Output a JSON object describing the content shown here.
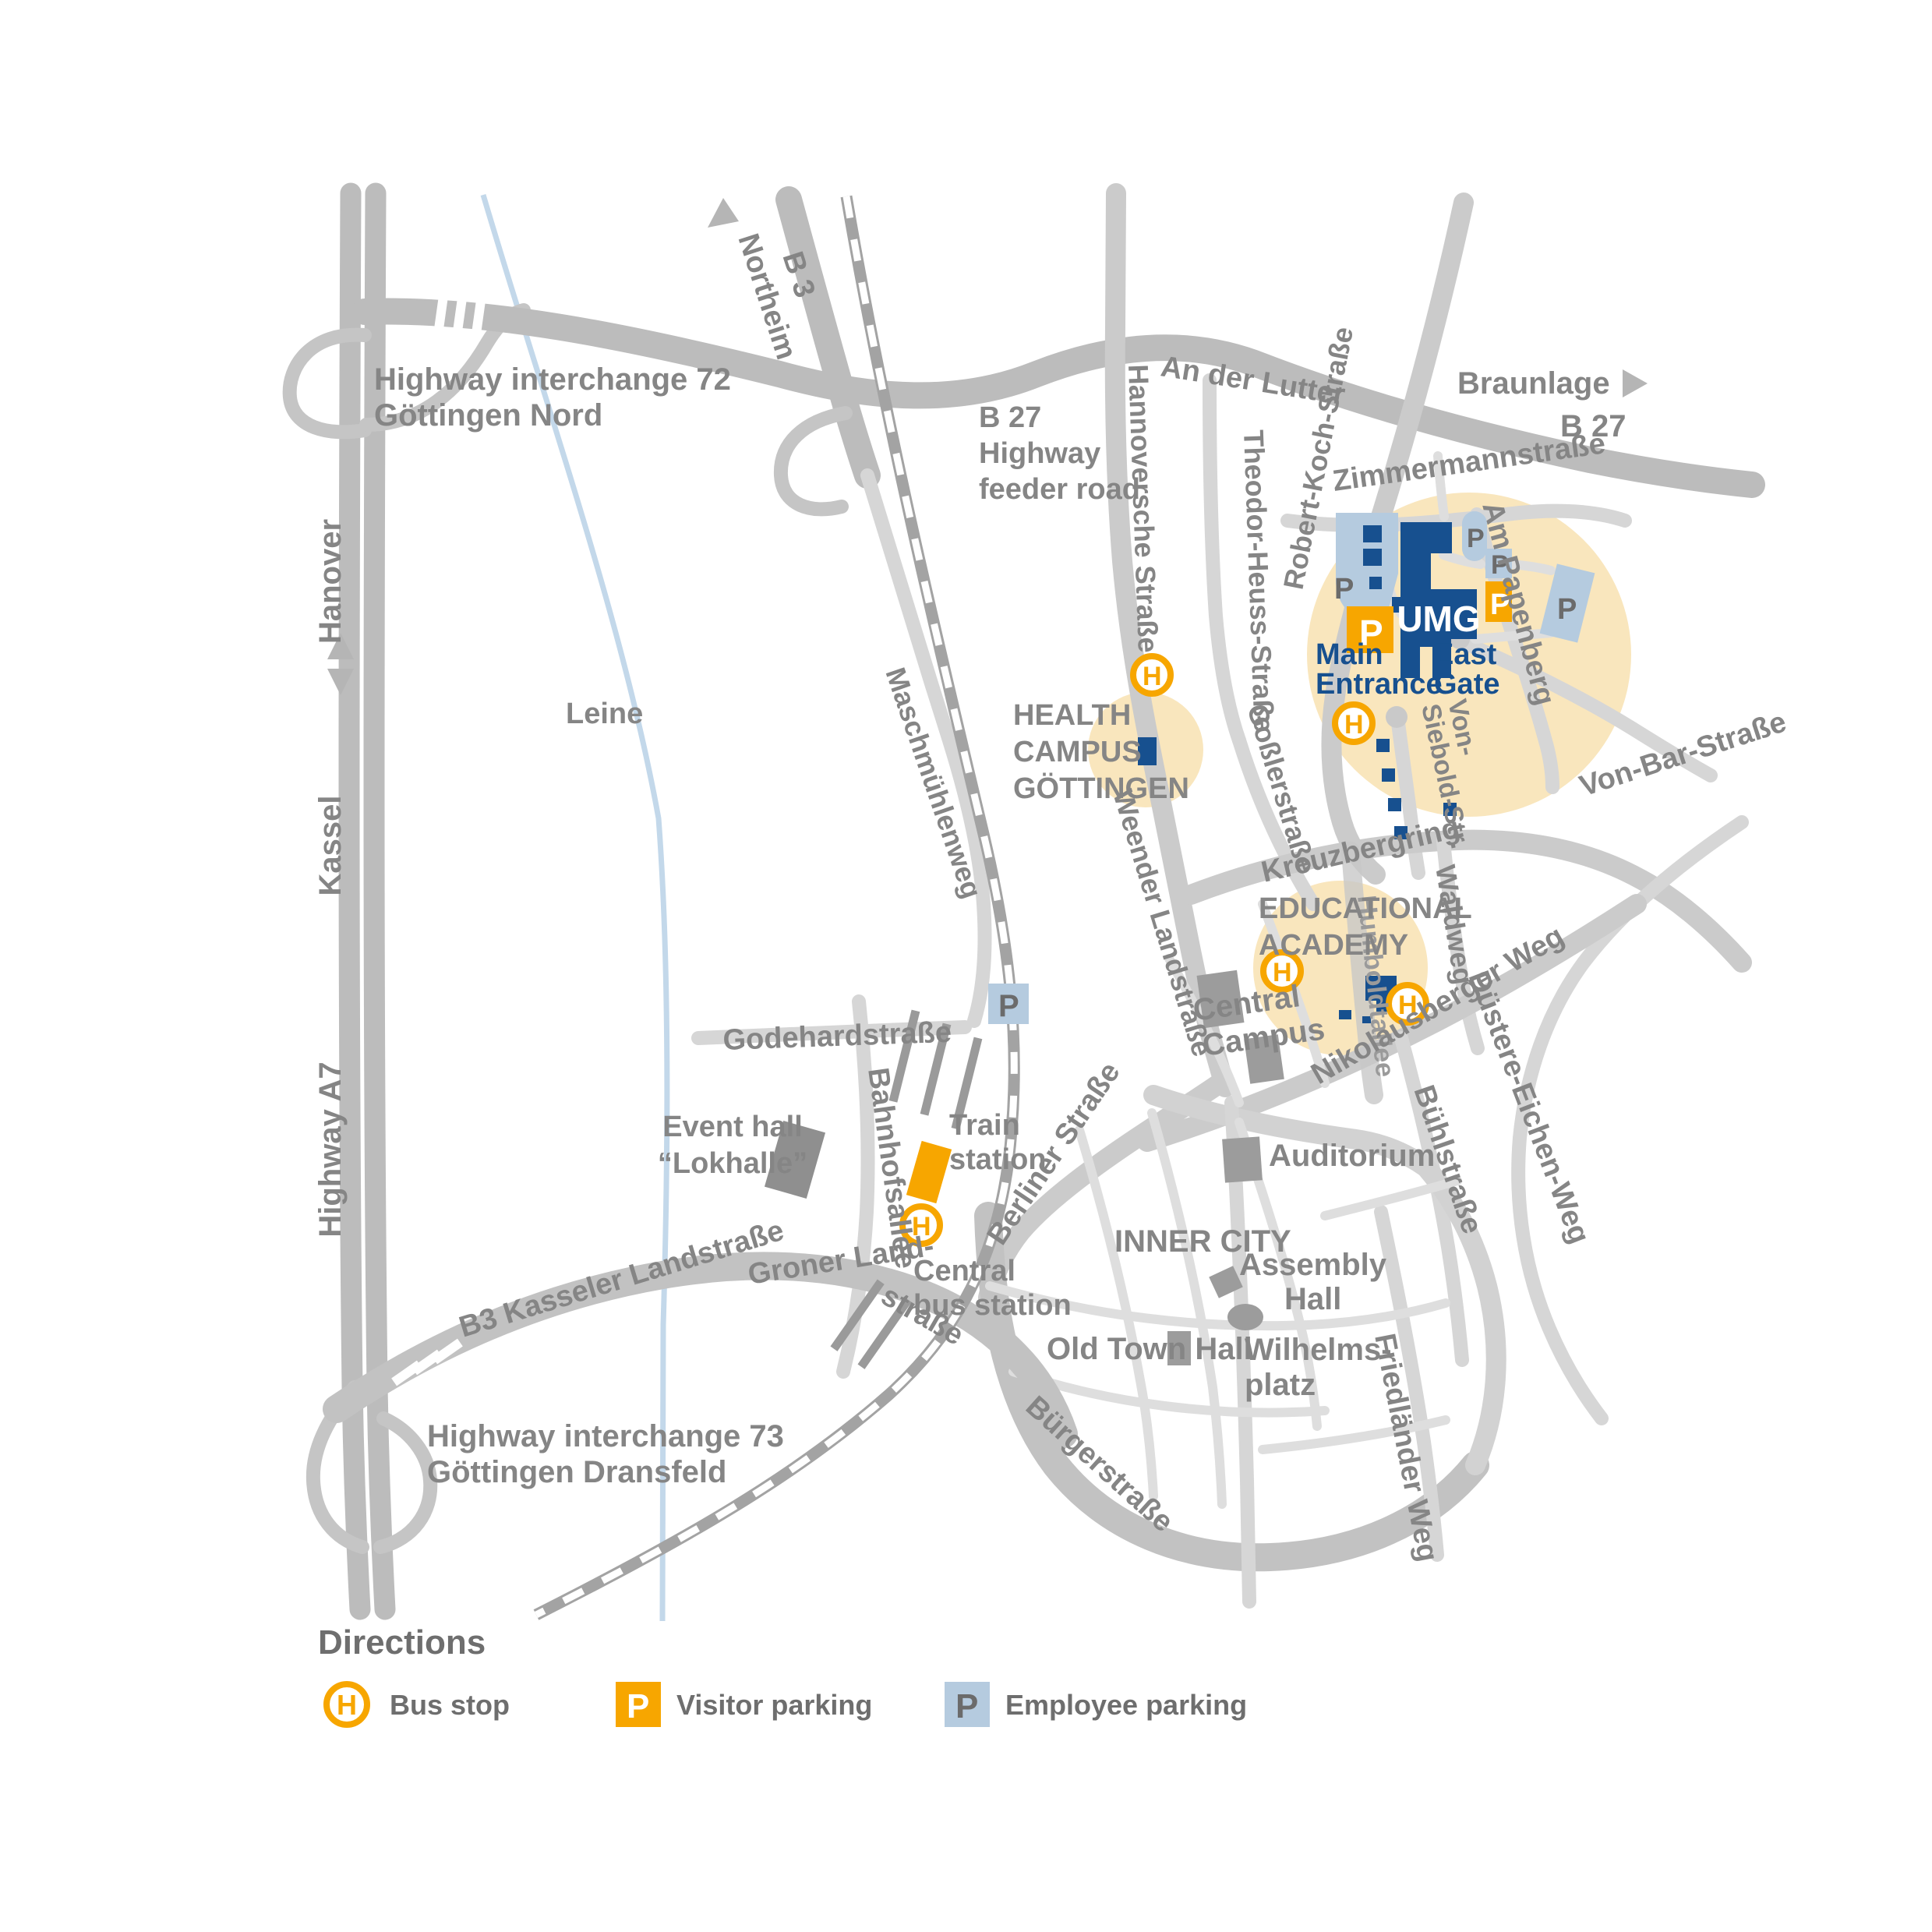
{
  "colors": {
    "accent_orange": "#F7A600",
    "umg_blue": "#17508F",
    "employee_parking_blue": "#B5CBDF",
    "campus_halo_beige": "#F9E6BD"
  },
  "icons": {
    "bus": "H",
    "parking": "P"
  },
  "legend": {
    "title": "Directions",
    "bus_stop": "Bus stop",
    "visitor_parking": "Visitor parking",
    "employee_parking": "Employee parking"
  },
  "highways": {
    "interchange_72": [
      "Highway interchange 72",
      "Göttingen Nord"
    ],
    "interchange_73": [
      "Highway interchange 73",
      "Göttingen Dransfeld"
    ],
    "a7": "Highway A7",
    "hanover": "Hanover",
    "kassel": "Kassel",
    "northeim": "Northeim",
    "braunlage": "Braunlage",
    "b3": "B 3",
    "b27": "B 27",
    "b27_feeder": [
      "B 27",
      "Highway",
      "feeder road"
    ]
  },
  "streets": {
    "an_der_lutter": "An der Lutter",
    "hannoversche": "Hannoversche Straße",
    "theodor_heuss": "Theodor-Heuss-Straße",
    "robert_koch": "Robert-Koch-Straße",
    "zimmermann": "Zimmermannstraße",
    "am_papenberg": "Am Papenberg",
    "von_siebold": [
      "Von-",
      "Siebold-Str."
    ],
    "von_bar": "Von-Bar-Straße",
    "kreuzbergring": "Kreuzbergring",
    "gossler": "Goßlerstraße",
    "weender": "Weender Landstraße",
    "maschmuehlenweg": "Maschmühlenweg",
    "humboldtallee": "Humboldtallee",
    "nikolausberger": "Nikolausberger Weg",
    "waldweg": "Waldweg",
    "buehl": "Bühlstraße",
    "duestere_eichen": "Düstere-Eichen-Weg",
    "friedlaender": "Friedländer Weg",
    "buerger": "Bürgerstraße",
    "berliner": "Berliner Straße",
    "kasseler": "B3 Kasseler Landstraße",
    "groner_1": "Groner Land-",
    "groner_2": "straße",
    "godehard": "Godehardstraße",
    "bahnhofsallee": "Bahnhofsallee"
  },
  "campus": {
    "umg": "UMG",
    "main_entrance": [
      "Main",
      "Entrance"
    ],
    "east_gate": [
      "East",
      "Gate"
    ],
    "health_campus": [
      "HEALTH",
      "CAMPUS",
      "GÖTTINGEN"
    ],
    "educational_academy": [
      "EDUCATIONAL",
      "ACADEMY"
    ]
  },
  "places": {
    "central_campus": [
      "Central",
      "Campus"
    ],
    "auditorium": "Auditorium",
    "inner_city": "INNER CITY",
    "assembly_hall": [
      "Assembly",
      "Hall"
    ],
    "wilhelmsplatz": [
      "Wilhelms-",
      "platz"
    ],
    "old_town_hall": "Old Town Hall",
    "train_station": [
      "Train",
      "station"
    ],
    "central_bus_station": [
      "Central",
      "bus station"
    ],
    "event_hall": [
      "Event hall",
      "“Lokhalle”"
    ],
    "leine": "Leine"
  }
}
